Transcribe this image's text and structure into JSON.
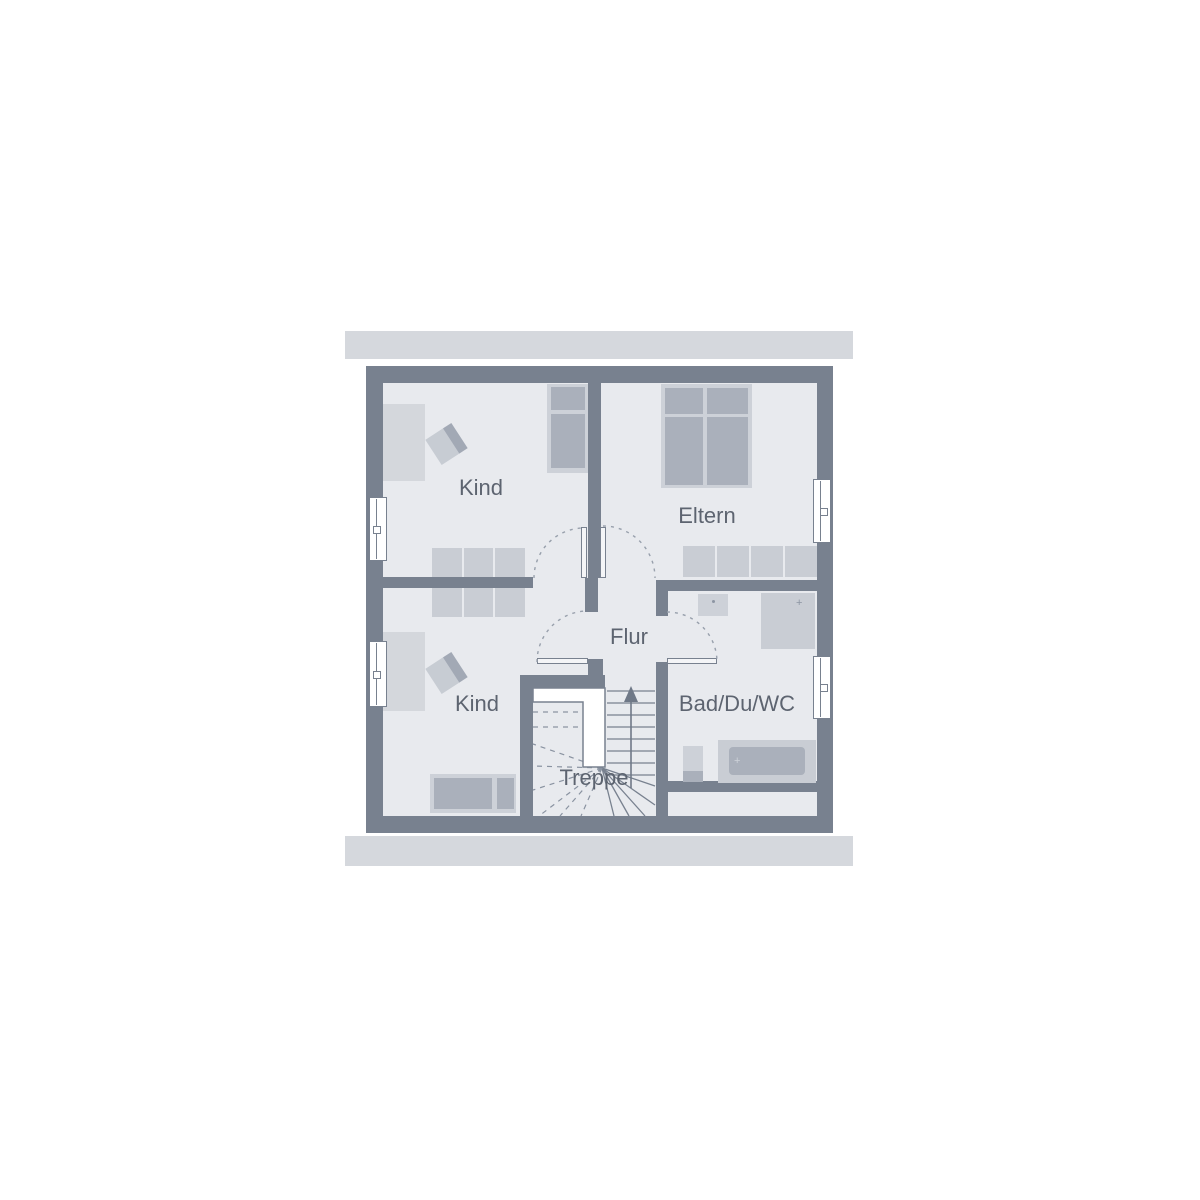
{
  "plan": {
    "type_note": "upper floor plan",
    "rooms": {
      "kind_top": {
        "label": "Kind"
      },
      "eltern": {
        "label": "Eltern"
      },
      "kind_bottom": {
        "label": "Kind"
      },
      "flur": {
        "label": "Flur"
      },
      "treppe": {
        "label": "Treppe"
      },
      "bad": {
        "label": "Bad/Du/WC"
      }
    }
  },
  "colors": {
    "background": "#ffffff",
    "wall": "#78818f",
    "floor": "#e8eaee",
    "eaves": "#d5d8dd",
    "furniture-light": "#cdd1d8",
    "furniture-lighter": "#d4d7dc",
    "furniture-medium": "#aab0bb",
    "wardrobe": "#c9cdd4",
    "text": "#5d6470",
    "dash": "#98a0ac",
    "stair-line": "#78818f",
    "window-fill": "#ffffff"
  }
}
